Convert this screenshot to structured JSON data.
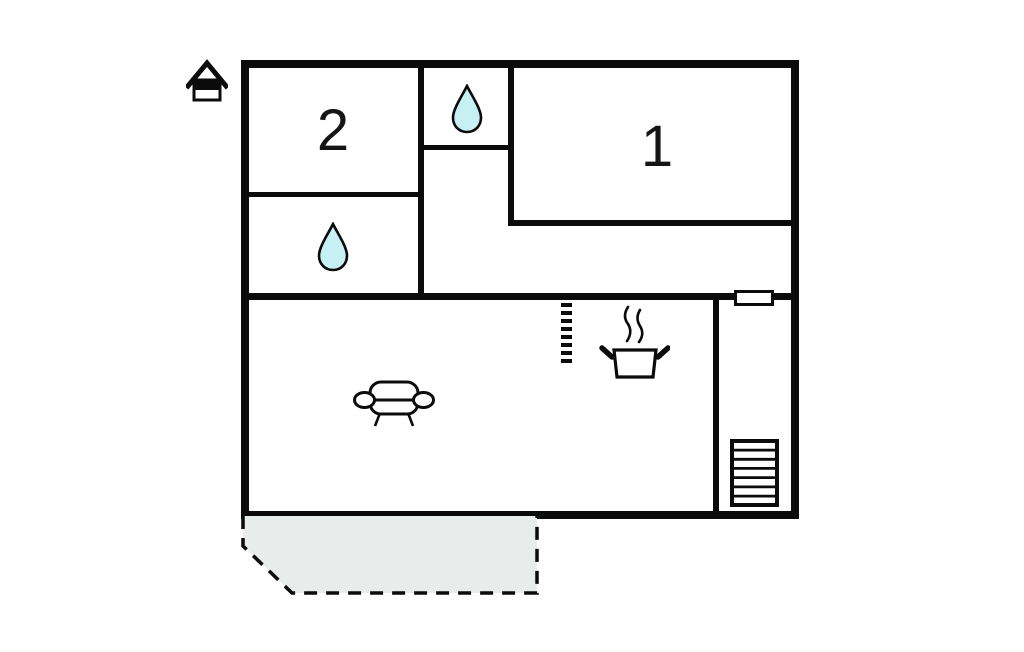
{
  "floorplan": {
    "rooms": [
      {
        "label": "1"
      },
      {
        "label": "2"
      }
    ],
    "colors": {
      "background": "#ffffff",
      "wall": "#0b0b0b",
      "water_drop": "#c6f0f4",
      "terrace": "#e8eceb"
    },
    "icons": [
      "house-icon",
      "water-drop-icon",
      "water-drop-icon",
      "sofa-icon",
      "cooking-pot-icon",
      "stairs-icon",
      "window-marker",
      "room-divider-dashed",
      "terrace-area"
    ]
  }
}
